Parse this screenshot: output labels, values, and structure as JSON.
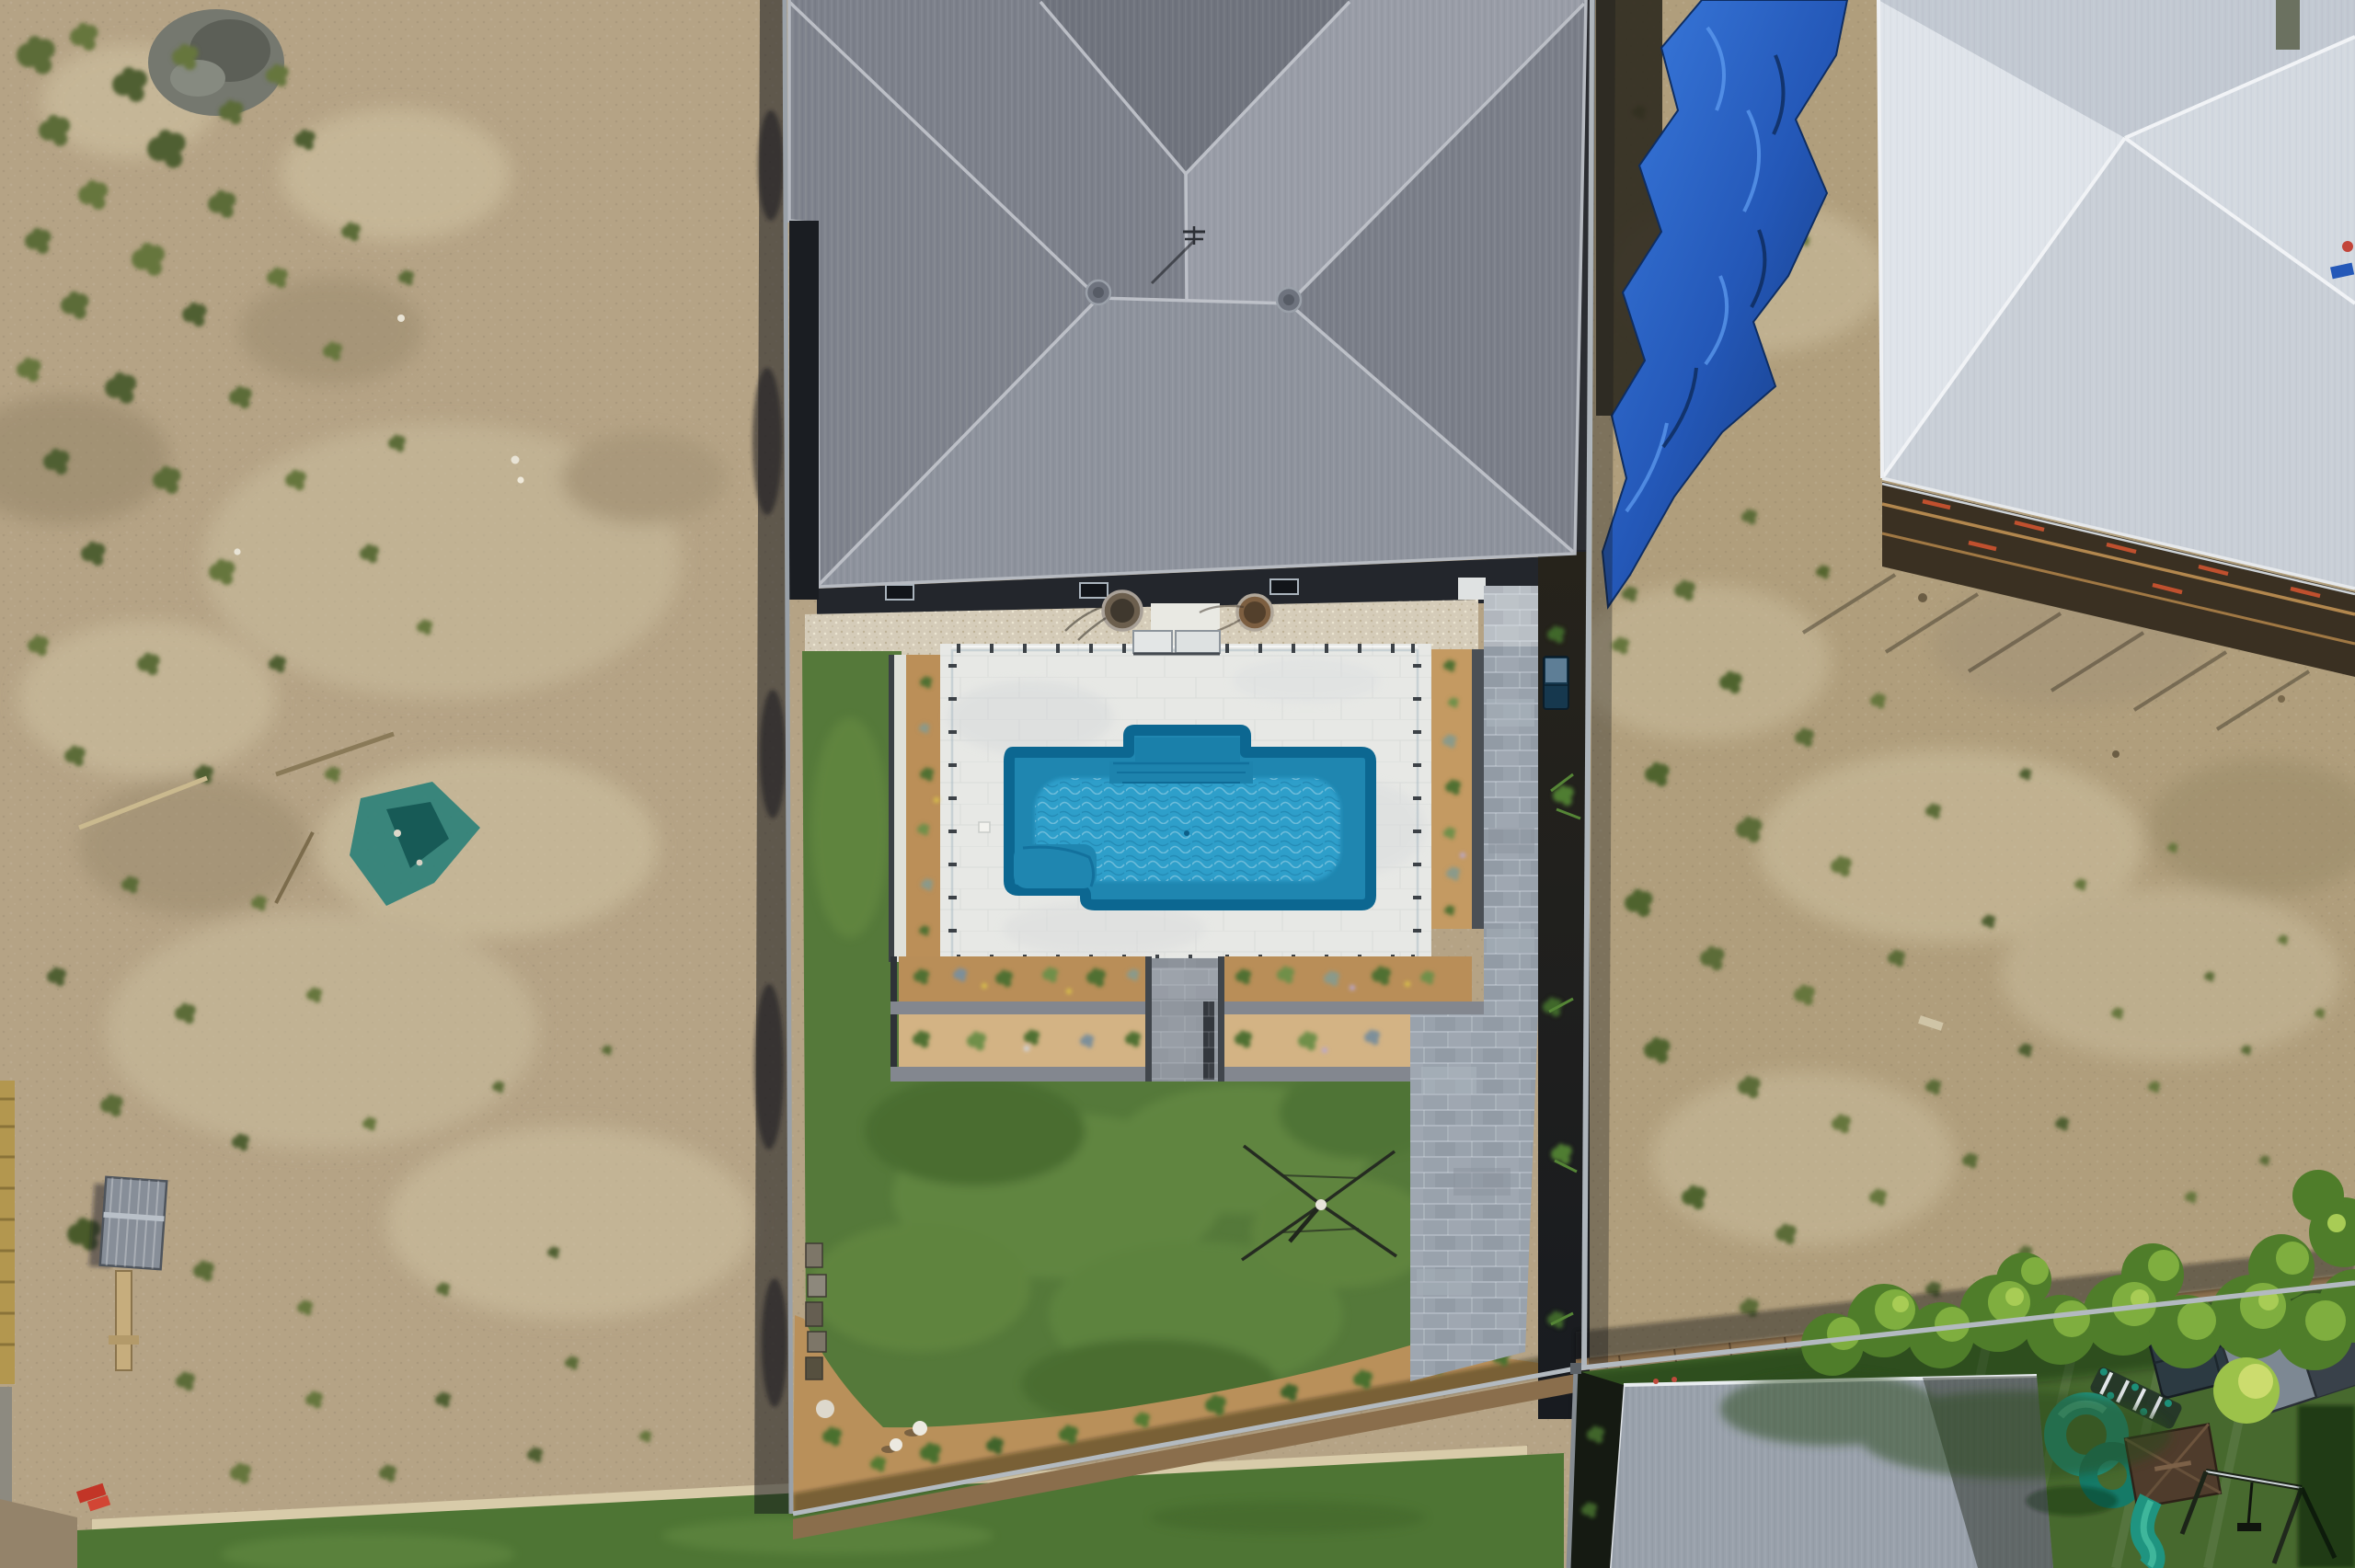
{
  "scene": {
    "description": "Top-down aerial drone photo of a suburban backyard: grey hip-roof house at top, fenced white-paved pool area with bright blue rectangular fibreglass pool, mulch garden beds, large green lawn with rotary clothesline, grey stone path on the right, vacant sandy lots either side, house under construction with blue tarp and scaffolding at top right, and a neighbouring yard at bottom right with artificial turf, green tube slide, timber play fort, swing set, grey canopy and trees.",
    "view": "top-down aerial",
    "lighting": "bright midday sun, hard shadows"
  },
  "objects": [
    {
      "label": "main-house-roof",
      "type": "grey corrugated hip roof with two whirlybird vents and TV antenna"
    },
    {
      "label": "pool",
      "type": "rectangular blue pool with top bench bump and swim-out step"
    },
    {
      "label": "pool-surround",
      "type": "white stone paving inside glass pool fence"
    },
    {
      "label": "glass-pool-fence",
      "type": "frameless glass fence with dark posts and double gate"
    },
    {
      "label": "garden-beds",
      "type": "terraced mulch beds with small shrubs and flowers"
    },
    {
      "label": "lawn",
      "type": "green lawn with rotary clothesline shadow"
    },
    {
      "label": "stone-path",
      "type": "blue-grey paver path along right boundary"
    },
    {
      "label": "left-vacant-lot",
      "type": "sandy dirt block with weeds, debris and corrugated sheet"
    },
    {
      "label": "right-vacant-lot",
      "type": "sandy dirt block with scattered weeds"
    },
    {
      "label": "construction-house",
      "type": "new build with pale roof, scaffolding and blue tarp"
    },
    {
      "label": "neighbour-yard",
      "type": "artificial turf, grey roof, play fort, green tube slide, swing set, canopy, trees"
    },
    {
      "label": "boundary-fences",
      "type": "timber fences with sunlit caps meeting at an X junction"
    }
  ],
  "palette": {
    "dirt": "#b5a385",
    "dirt_right": "#b09e7c",
    "lawn": "#55793a",
    "turf": "#47692e",
    "pool_water": "#2a9bc8",
    "pool_flat": "#1f86b0",
    "pool_shell": "#0d6a95",
    "white_paving": "#e7e8e5",
    "pebble_patio": "#d5ccb9",
    "mulch": "#b98e58",
    "mulch_light": "#d3b384",
    "path_pavers": "#99a2ac",
    "main_roof": "#868a94",
    "construction_roof": "#cdd3da",
    "tarp_blue": "#2e6fd0",
    "tarp_blue_dark": "#123a7e",
    "slide_green": "#1f9480",
    "fort_brown": "#4f3c2c",
    "tree_green": "#4f7d2a",
    "fence_cap": "#b3bac0",
    "deep_shadow": "#1d2025",
    "scaffold_rust": "#c0502e",
    "toy_red": "#c23527"
  }
}
